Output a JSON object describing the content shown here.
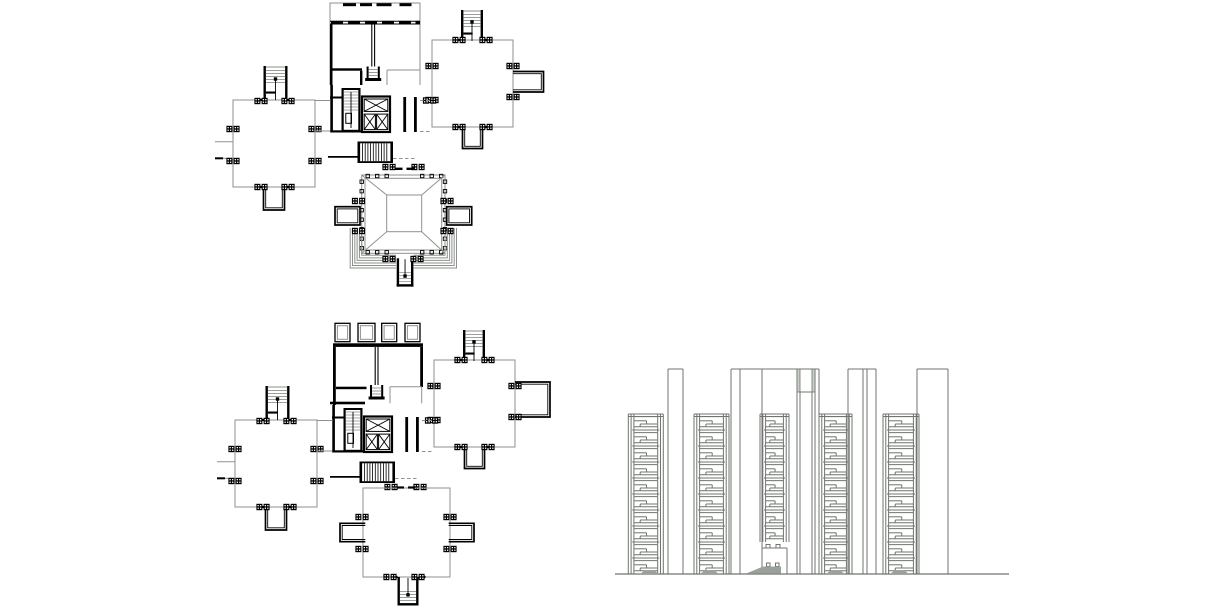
{
  "scene": {
    "width": 1220,
    "height": 610,
    "background": "#ffffff",
    "description": "architectural CAD drawing: two floor plans and one building elevation"
  },
  "palette": {
    "ink": "#000000",
    "thin": "#8d928d",
    "tread": "#9aa09a",
    "elev": "#6f746e",
    "mound": "#9aa09a",
    "cap_fill": "#c9cec9",
    "white": "#ffffff"
  },
  "plans": [
    {
      "name": "upper-floor-plan",
      "offset": [
        0,
        0
      ],
      "top_block": "slab_row",
      "bottom": "pavilion",
      "protrusion": [
        513,
        71.5,
        30.5,
        20.5
      ]
    },
    {
      "name": "lower-floor-plan",
      "offset": [
        2,
        320
      ],
      "top_block": "balcony_row",
      "bottom": "octagon_wing",
      "protrusion": [
        513,
        62,
        35,
        35
      ]
    }
  ],
  "wing_left": {
    "rect": [
      233,
      100,
      82,
      87
    ],
    "stair": [
      263.5,
      66,
      24,
      35
    ],
    "balcony": [
      263.5,
      187,
      21,
      23
    ],
    "stub_y": [
      141.7,
      158.3
    ],
    "stub_x": [
      215,
      233
    ],
    "markers": [
      [
        261,
        101
      ],
      [
        288,
        101
      ],
      [
        233,
        129
      ],
      [
        233,
        161
      ],
      [
        315,
        129
      ],
      [
        315,
        161
      ],
      [
        261,
        187
      ],
      [
        288,
        187
      ]
    ]
  },
  "wing_right": {
    "rect": [
      432,
      40,
      81,
      87
    ],
    "stair": [
      461,
      10,
      22,
      32
    ],
    "balcony": [
      462.5,
      127,
      20,
      21.5
    ],
    "markers": [
      [
        459,
        40
      ],
      [
        486,
        40
      ],
      [
        432,
        66
      ],
      [
        432,
        100
      ],
      [
        513,
        66
      ],
      [
        513,
        97
      ],
      [
        459,
        127
      ],
      [
        486,
        127
      ]
    ]
  },
  "core": {
    "left_wall": [
      330.3,
      85,
      2.6,
      47.5
    ],
    "stub": [
      330,
      97.5,
      341.5,
      97.5
    ],
    "bottom_bar": [
      330.3,
      130.3,
      31,
      2.2
    ],
    "stair": [
      341.5,
      88,
      19,
      44
    ],
    "closet": [
      345.8,
      113.3,
      5.7,
      10
    ],
    "elevators": [
      362,
      96.5,
      28,
      35.5
    ],
    "corridor": [
      [
        403.3,
        97,
        2.8,
        35
      ],
      [
        414,
        97,
        2.8,
        35
      ]
    ],
    "marker": [
      429.5,
      100.5
    ]
  },
  "mid_stair": {
    "rect": [
      357.5,
      141.5,
      35.5,
      21.5
    ],
    "markers": [
      [
        389,
        167
      ],
      [
        418,
        167
      ]
    ]
  },
  "top_block_slab_row": {
    "frame": [
      330,
      3,
      90,
      21
    ],
    "side_wall_top": 3,
    "side_wall_bottom": 85,
    "dashes_y": 3.2,
    "dash_h": 3,
    "dashes": [
      [
        343,
        13
      ],
      [
        360,
        12
      ],
      [
        376.5,
        15
      ],
      [
        399.5,
        12
      ]
    ],
    "lines_y": [
      21.2,
      24
    ],
    "piers_y": 20.9,
    "pier_h": 3.2,
    "piers": [
      [
        331,
        12
      ],
      [
        348,
        12
      ],
      [
        365,
        12
      ],
      [
        382,
        12
      ],
      [
        399,
        12
      ],
      [
        415.5,
        4.5
      ]
    ],
    "left_wall": [
      330,
      24,
      2.5,
      61
    ],
    "center_x": [
      371.8,
      374.6
    ],
    "center_y": [
      24,
      66.5
    ],
    "hearth": [
      373.2,
      66.5
    ],
    "bl_wall": [
      330,
      68.3,
      32,
      2.4
    ],
    "bl_drop": [
      360,
      70.7,
      2.4,
      14.3
    ],
    "br_room": [
      387,
      70,
      33,
      15
    ]
  },
  "top_block_balcony_row": {
    "squares": [
      [
        333,
        3.3,
        15,
        18.4
      ],
      [
        356,
        3.3,
        17,
        18.4
      ],
      [
        379.7,
        3.3,
        15,
        18.4
      ],
      [
        403,
        3.3,
        15,
        18.4
      ]
    ],
    "top_wall": [
      331,
      23.3,
      90,
      3.6
    ],
    "left_wall": [
      331,
      27,
      2.8,
      58
    ],
    "right_wall": [
      418.2,
      27,
      2.8,
      40
    ],
    "center_x": [
      373.2,
      376
    ],
    "center_y": [
      27,
      65
    ],
    "hearth": [
      374.6,
      65
    ],
    "bl_wall": [
      334,
      66.7,
      30.5,
      2.5
    ],
    "bl_wall2": [
      328,
      81.7,
      35,
      2.6
    ],
    "br_room": [
      388,
      66.7,
      31.7,
      16.6
    ]
  },
  "links": {
    "gray": [
      [
        315,
        100.5,
        330,
        100.5
      ],
      [
        315,
        131,
        330,
        131
      ]
    ],
    "dashed": [
      [
        420,
        100.5,
        432,
        100.5
      ],
      [
        420,
        131.5,
        432,
        131.5
      ],
      [
        393,
        158.5,
        416,
        158.5
      ]
    ],
    "wall": [
      328,
      156.9,
      357.5,
      156.9
    ]
  },
  "pavilion": {
    "outer": [
      361.7,
      175,
      83.3,
      78.3
    ],
    "inner": [
      365,
      178.3,
      76.7,
      71.7
    ],
    "roof_inner": [
      386.7,
      195,
      35,
      36.7
    ],
    "col_size": 3.4,
    "col_top_x": [
      366,
      375.5,
      385,
      420.5,
      430,
      439.5
    ],
    "col_side_y": [
      180,
      189.5,
      199,
      208.5,
      218,
      227.5,
      237,
      246.5
    ],
    "entry_dashes": [
      [
        395,
        168.8,
        402.5
      ],
      [
        406.5,
        168.8,
        414
      ]
    ],
    "balcony_left": [
      335,
      206.7,
      25,
      18.3
    ],
    "balcony_right": [
      446.7,
      206.7,
      25,
      18.3
    ],
    "stair": [
      396.7,
      258.3,
      16.7,
      28.3
    ],
    "terrace_steps": 6,
    "markers": [
      [
        358.5,
        201
      ],
      [
        358.5,
        231
      ],
      [
        447,
        201
      ],
      [
        447,
        231
      ],
      [
        389,
        259
      ],
      [
        417,
        259
      ]
    ]
  },
  "octagon_wing": {
    "rect": [
      361,
      168,
      87,
      89
    ],
    "balcony_left": [
      338,
      203.3,
      25.3,
      18.4
    ],
    "balcony_right": [
      446.7,
      203.3,
      25.3,
      18.4
    ],
    "stair": [
      395.5,
      257,
      21,
      28.5
    ],
    "entry_dashes": [
      [
        395,
        167.5,
        402
      ],
      [
        406,
        167.5,
        413
      ]
    ],
    "markers": [
      [
        360,
        197
      ],
      [
        360,
        229
      ],
      [
        448,
        197
      ],
      [
        448,
        229
      ],
      [
        388,
        257
      ],
      [
        416,
        257
      ]
    ]
  },
  "elevation": {
    "ground": [
      615,
      574,
      1009
    ],
    "bay_top": 414,
    "floor_h": 16,
    "bays": [
      {
        "x": 628.3,
        "w": 35,
        "floors": 10
      },
      {
        "x": 694,
        "w": 35,
        "floors": 10
      },
      {
        "x": 760,
        "w": 29,
        "floors": 8,
        "entrance": true
      },
      {
        "x": 819,
        "w": 33,
        "floors": 10
      },
      {
        "x": 883,
        "w": 36,
        "floors": 10
      }
    ],
    "piers": [
      {
        "x": 668,
        "w": 15,
        "lines": []
      },
      {
        "x": 731,
        "w": 31,
        "lines": [
          740
        ]
      },
      {
        "x": 848,
        "w": 28,
        "lines": [
          863,
          867
        ]
      },
      {
        "x": 917,
        "w": 31,
        "lines": []
      }
    ],
    "pier_top": 369,
    "roof_line": [
      762,
      819
    ],
    "roof_drop_x": 819,
    "shaft": {
      "outer": [
        797,
        815
      ],
      "inner": [
        800,
        812
      ],
      "cap_bottom": 392
    },
    "mounds": [
      [
        640,
        659
      ],
      [
        700,
        719
      ],
      [
        826,
        845
      ],
      [
        890,
        909
      ]
    ],
    "entrance": {
      "x": 760,
      "w": 29,
      "top": 542
    }
  }
}
